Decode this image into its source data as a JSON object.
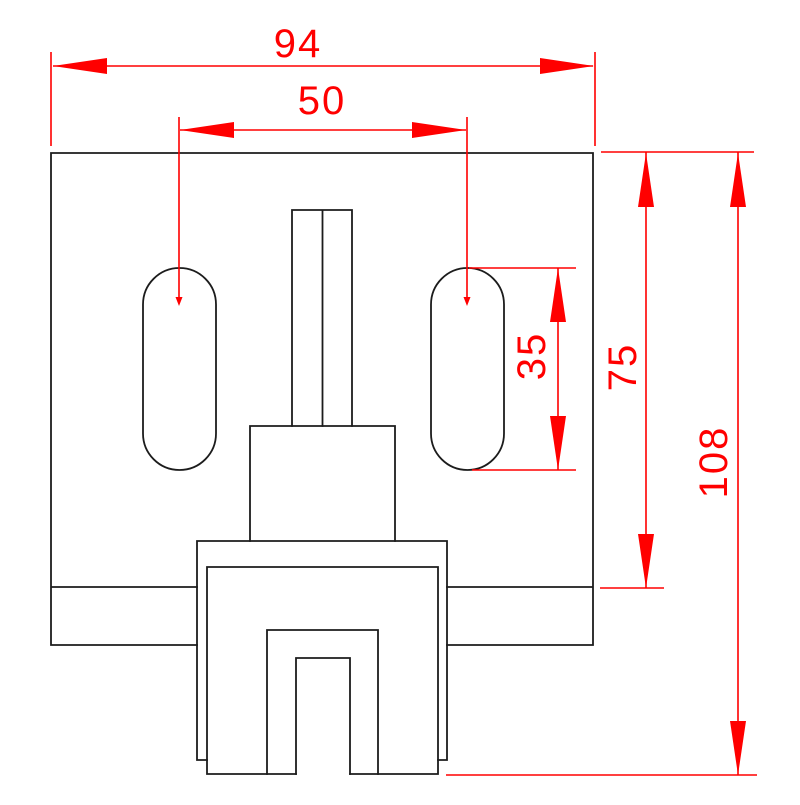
{
  "drawing": {
    "kind": "technical-dimension-drawing",
    "view": "front view of slotted clamp bracket",
    "colors": {
      "outline": "#1c1c1c",
      "dimension": "#ff0000",
      "background": "#ffffff"
    },
    "dimensions": [
      {
        "id": "overall-width",
        "label": "94",
        "orientation": "horizontal",
        "measures": "overall plate width"
      },
      {
        "id": "slot-spacing",
        "label": "50",
        "orientation": "horizontal",
        "measures": "center distance between the two slots"
      },
      {
        "id": "slot-length",
        "label": "35",
        "orientation": "vertical",
        "measures": "length of rounded slot"
      },
      {
        "id": "plate-height",
        "label": "75",
        "orientation": "vertical",
        "measures": "plate face height to step line"
      },
      {
        "id": "overall-height",
        "label": "108",
        "orientation": "vertical",
        "measures": "overall height to clamp bottom"
      }
    ]
  }
}
